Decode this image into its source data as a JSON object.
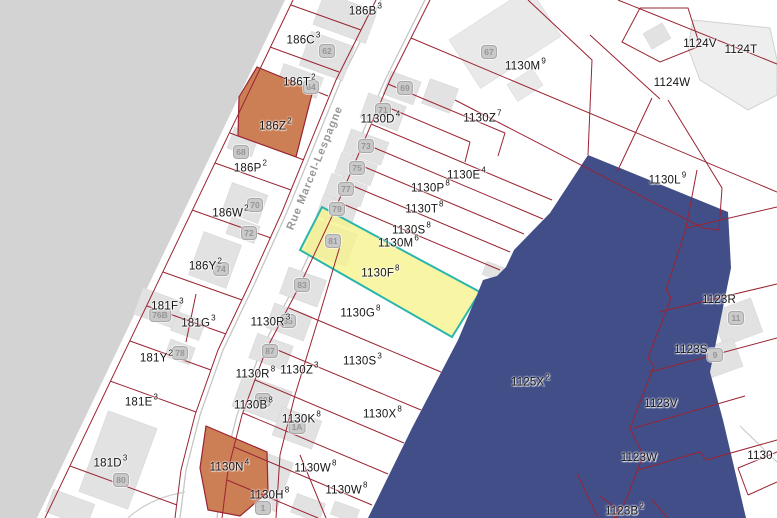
{
  "map": {
    "street_label": "Rue Marcel-Lespagne",
    "colors": {
      "selection_fill": "#f6f29b",
      "selection_border": "#2ab5ad",
      "zone_fill": "#414e87",
      "parcel_line": "#9a2433",
      "orange_parcel_fill": "#cc7e55",
      "outside_area_fill": "#d3d3d3",
      "building_fill": "#e2e2e2"
    },
    "selected_parcel": {
      "label": "1130F",
      "sup": "8"
    },
    "parcels": [
      {
        "label": "186B",
        "sup": "3",
        "x": 365,
        "y": 10
      },
      {
        "label": "186C",
        "sup": "3",
        "x": 303,
        "y": 39
      },
      {
        "label": "186T",
        "sup": "2",
        "x": 299,
        "y": 81
      },
      {
        "label": "186Z",
        "sup": "2",
        "x": 275,
        "y": 125
      },
      {
        "label": "186P",
        "sup": "2",
        "x": 250,
        "y": 167
      },
      {
        "label": "186W",
        "sup": "2",
        "x": 230,
        "y": 212
      },
      {
        "label": "186Y",
        "sup": "2",
        "x": 205,
        "y": 265
      },
      {
        "label": "181F",
        "sup": "3",
        "x": 167,
        "y": 305
      },
      {
        "label": "181G",
        "sup": "3",
        "x": 198,
        "y": 322
      },
      {
        "label": "181Y",
        "sup": "2",
        "x": 156,
        "y": 357
      },
      {
        "label": "181E",
        "sup": "3",
        "x": 141,
        "y": 401
      },
      {
        "label": "181D",
        "sup": "3",
        "x": 110,
        "y": 462
      },
      {
        "label": "1130D",
        "sup": "4",
        "x": 380,
        "y": 118
      },
      {
        "label": "1130Z",
        "sup": "7",
        "x": 482,
        "y": 117
      },
      {
        "label": "1130M",
        "sup": "9",
        "x": 525,
        "y": 65
      },
      {
        "label": "1130E",
        "sup": "4",
        "x": 466,
        "y": 174
      },
      {
        "label": "1130P",
        "sup": "8",
        "x": 430,
        "y": 187
      },
      {
        "label": "1130T",
        "sup": "8",
        "x": 424,
        "y": 208
      },
      {
        "label": "1130S",
        "sup": "8",
        "x": 411,
        "y": 229
      },
      {
        "label": "1130M",
        "sup": "6",
        "x": 398,
        "y": 242
      },
      {
        "label": "1130F",
        "sup": "8",
        "x": 380,
        "y": 272
      },
      {
        "label": "1130G",
        "sup": "8",
        "x": 360,
        "y": 312
      },
      {
        "label": "1130R",
        "sup": "3",
        "x": 270,
        "y": 321
      },
      {
        "label": "1130S",
        "sup": "3",
        "x": 362,
        "y": 360
      },
      {
        "label": "1130Z",
        "sup": "3",
        "x": 299,
        "y": 369
      },
      {
        "label": "1130R",
        "sup": "8",
        "x": 255,
        "y": 373
      },
      {
        "label": "1130B",
        "sup": "8",
        "x": 253,
        "y": 404
      },
      {
        "label": "1130X",
        "sup": "8",
        "x": 382,
        "y": 413
      },
      {
        "label": "1130K",
        "sup": "8",
        "x": 301,
        "y": 418
      },
      {
        "label": "1130N",
        "sup": "4",
        "x": 229,
        "y": 466
      },
      {
        "label": "1130W",
        "sup": "8",
        "x": 315,
        "y": 467
      },
      {
        "label": "1130W",
        "sup": "8",
        "x": 346,
        "y": 489
      },
      {
        "label": "1130H",
        "sup": "8",
        "x": 269,
        "y": 494
      },
      {
        "label": "1124V",
        "sup": "",
        "x": 700,
        "y": 44
      },
      {
        "label": "1124T",
        "sup": "",
        "x": 741,
        "y": 50
      },
      {
        "label": "1124W",
        "sup": "",
        "x": 672,
        "y": 83
      },
      {
        "label": "1130L",
        "sup": "9",
        "x": 667,
        "y": 179
      },
      {
        "label": "1123R",
        "sup": "",
        "x": 719,
        "y": 300
      },
      {
        "label": "1123S",
        "sup": "",
        "x": 691,
        "y": 350
      },
      {
        "label": "1123V",
        "sup": "",
        "x": 661,
        "y": 404
      },
      {
        "label": "1123W",
        "sup": "",
        "x": 639,
        "y": 458
      },
      {
        "label": "1123B",
        "sup": "2",
        "x": 624,
        "y": 510
      },
      {
        "label": "1125X",
        "sup": "2",
        "x": 530,
        "y": 381
      },
      {
        "label": "1130",
        "sup": "",
        "x": 760,
        "y": 456
      }
    ],
    "address_badges": [
      {
        "text": "62",
        "x": 327,
        "y": 51
      },
      {
        "text": "64",
        "x": 311,
        "y": 87
      },
      {
        "text": "67",
        "x": 489,
        "y": 52
      },
      {
        "text": "68",
        "x": 241,
        "y": 152
      },
      {
        "text": "69",
        "x": 405,
        "y": 88
      },
      {
        "text": "70",
        "x": 255,
        "y": 205
      },
      {
        "text": "71",
        "x": 383,
        "y": 110
      },
      {
        "text": "72",
        "x": 249,
        "y": 233
      },
      {
        "text": "73",
        "x": 366,
        "y": 146
      },
      {
        "text": "74",
        "x": 221,
        "y": 269
      },
      {
        "text": "75",
        "x": 357,
        "y": 168
      },
      {
        "text": "76B",
        "x": 160,
        "y": 315
      },
      {
        "text": "77",
        "x": 346,
        "y": 189
      },
      {
        "text": "78",
        "x": 180,
        "y": 353
      },
      {
        "text": "79",
        "x": 337,
        "y": 209
      },
      {
        "text": "80",
        "x": 121,
        "y": 480
      },
      {
        "text": "81",
        "x": 333,
        "y": 241
      },
      {
        "text": "83",
        "x": 302,
        "y": 285
      },
      {
        "text": "85",
        "x": 288,
        "y": 321
      },
      {
        "text": "87",
        "x": 270,
        "y": 351
      },
      {
        "text": "89",
        "x": 263,
        "y": 400
      },
      {
        "text": "1A",
        "x": 297,
        "y": 427
      },
      {
        "text": "1",
        "x": 263,
        "y": 508
      },
      {
        "text": "9",
        "x": 715,
        "y": 355
      },
      {
        "text": "11",
        "x": 736,
        "y": 318
      }
    ]
  }
}
